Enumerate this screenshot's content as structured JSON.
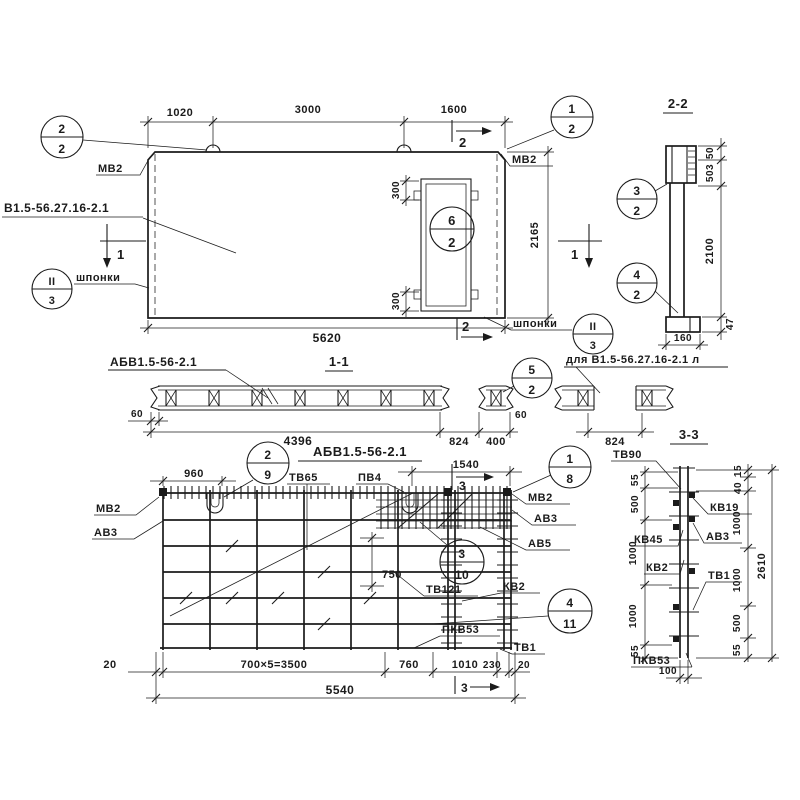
{
  "meta": {
    "bg": "#ffffff",
    "ink": "#1b1b1b"
  },
  "facade": {
    "dims": {
      "a": "1020",
      "b": "3000",
      "c": "1600",
      "total": "5620",
      "height": "2165",
      "open_top": "300",
      "open_bot": "300"
    },
    "labels": {
      "mv2_left": "МВ2",
      "mv2_right": "МВ2",
      "mark": "В1.5-56.27.16-2.1",
      "keys_left": "шпонки",
      "keys_right": "шпонки"
    },
    "markers": {
      "s1l": "1",
      "s1r": "1",
      "s2t": "2",
      "s2b": "2"
    },
    "callouts": {
      "c22": {
        "t": "2",
        "b": "2"
      },
      "c12": {
        "t": "1",
        "b": "2"
      },
      "c62": {
        "t": "6",
        "b": "2"
      },
      "keyl": {
        "t": "II",
        "b": "3"
      },
      "keyr": {
        "t": "II",
        "b": "3"
      }
    }
  },
  "sec22": {
    "title": "2-2",
    "dims": {
      "d50": "50",
      "d503": "503",
      "d2100": "2100",
      "d47": "47",
      "d160": "160"
    },
    "callouts": {
      "c32": {
        "t": "3",
        "b": "2"
      },
      "c42": {
        "t": "4",
        "b": "2"
      }
    }
  },
  "sec11": {
    "title": "1-1",
    "label": "АБВ1.5-56-2.1",
    "label_alt": "для В1.5-56.27.16-2.1 л",
    "dims": {
      "d60l": "60",
      "d4396": "4396",
      "d824a": "824",
      "d400": "400",
      "d60r": "60",
      "d824b": "824"
    },
    "callouts": {
      "c52": {
        "t": "5",
        "b": "2"
      }
    }
  },
  "mesh": {
    "title": "АБВ1.5-56-2.1",
    "dims": {
      "d960": "960",
      "d1540": "1540",
      "d750": "750",
      "d20l": "20",
      "d3500": "700×5=3500",
      "d760": "760",
      "d1010": "1010",
      "d230": "230",
      "d20r": "20",
      "d5540": "5540"
    },
    "labels": {
      "mv2_left": "МВ2",
      "av3_left": "АВ3",
      "tv65": "ТВ65",
      "pv4": "ПВ4",
      "mv2_right": "МВ2",
      "av3_right": "АВ3",
      "av5": "АВ5",
      "tv121": "ТВ121",
      "kv2": "КВ2",
      "pkv53": "ПКВ53",
      "tv1": "ТВ1"
    },
    "markers": {
      "s3t": "3",
      "s3b": "3"
    },
    "callouts": {
      "c29": {
        "t": "2",
        "b": "9"
      },
      "c18": {
        "t": "1",
        "b": "8"
      },
      "c310": {
        "t": "3",
        "b": "10"
      },
      "c411": {
        "t": "4",
        "b": "11"
      }
    }
  },
  "sec33": {
    "title": "3-3",
    "labels": {
      "tv90": "ТВ90",
      "kv45": "КВ45",
      "kv2": "КВ2",
      "pkv53": "ПКВ53",
      "kv19": "КВ19",
      "av3": "АВ3",
      "tv1": "ТВ1"
    },
    "dims": {
      "left": [
        "55",
        "500",
        "1000",
        "1000",
        "55"
      ],
      "right": [
        "15",
        "40",
        "1000",
        "1000",
        "500",
        "55"
      ],
      "total": "2610",
      "thick": "100"
    }
  }
}
